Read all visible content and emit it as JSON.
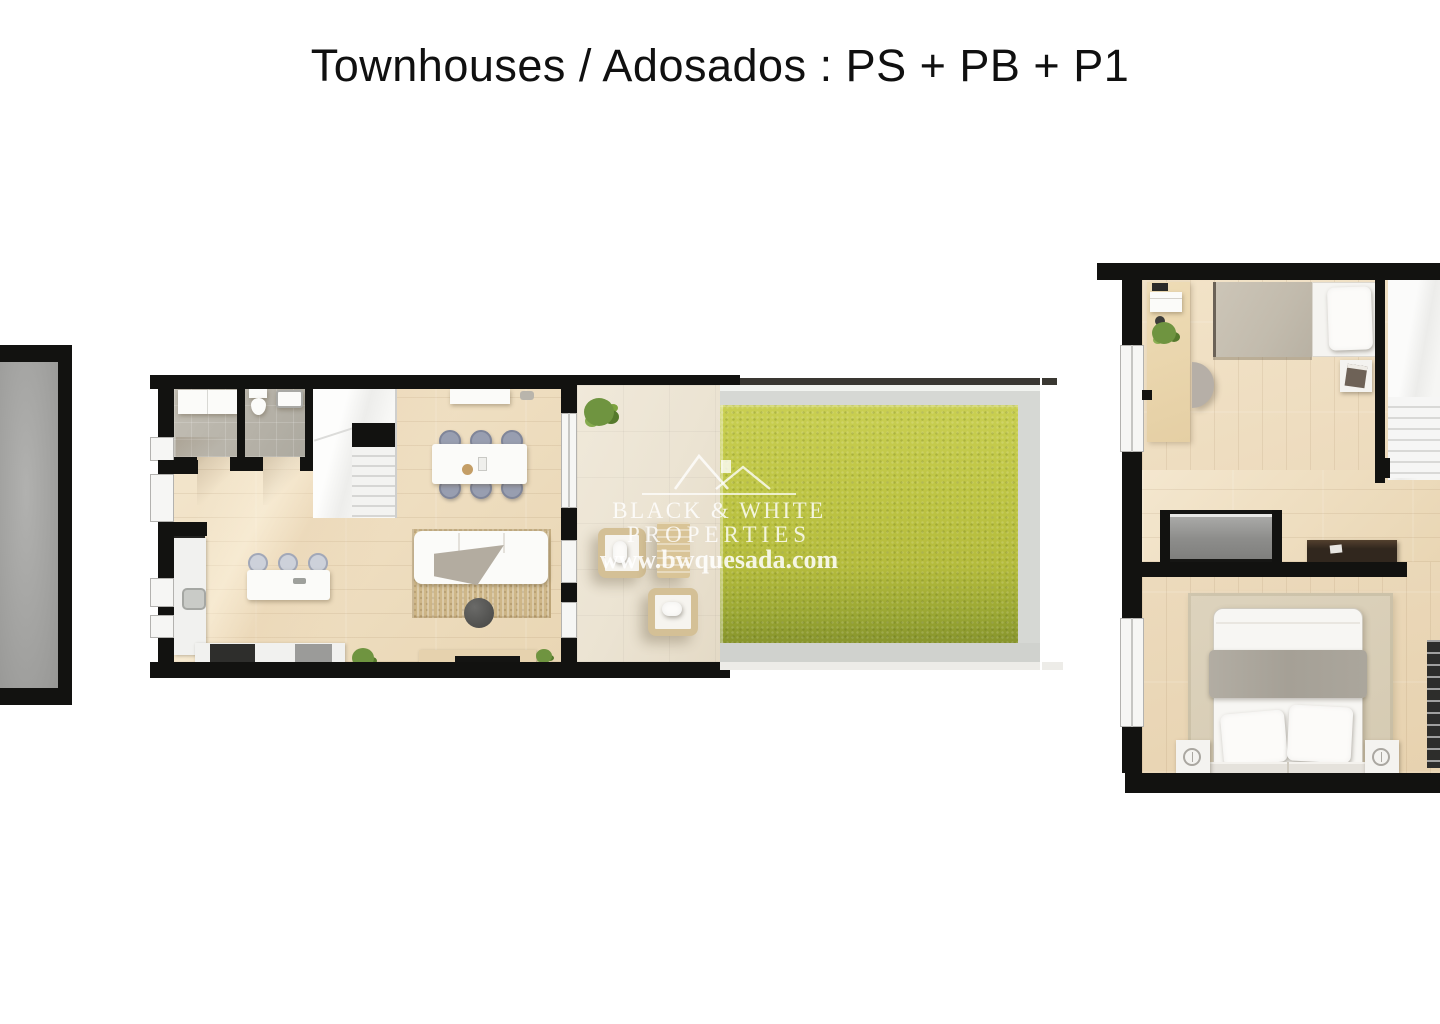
{
  "title": "Townhouses / Adosados : PS + PB + P1",
  "watermark": {
    "logo": "double-roof-house-icon",
    "line1": "BLACK & WHITE",
    "line2": "PROPERTIES",
    "website": "www.bwquesada.com"
  },
  "floors": {
    "basement": "PS",
    "ground": "PB",
    "first": "P1"
  },
  "colors": {
    "background": "#ffffff",
    "wall": "#121210",
    "title_text": "#101010",
    "wood_floor": "#efdfc2",
    "bathroom_tile": "#b5b1a7",
    "basement_concrete": "#a3a3a1",
    "terrace_tile": "#ebe3d2",
    "lawn": "#bdc443",
    "lawn_shadow": "#87942c",
    "walkway": "#d6d8d4",
    "gravel": "#e7dcca",
    "watermark": "rgba(255,255,255,0.82)"
  }
}
